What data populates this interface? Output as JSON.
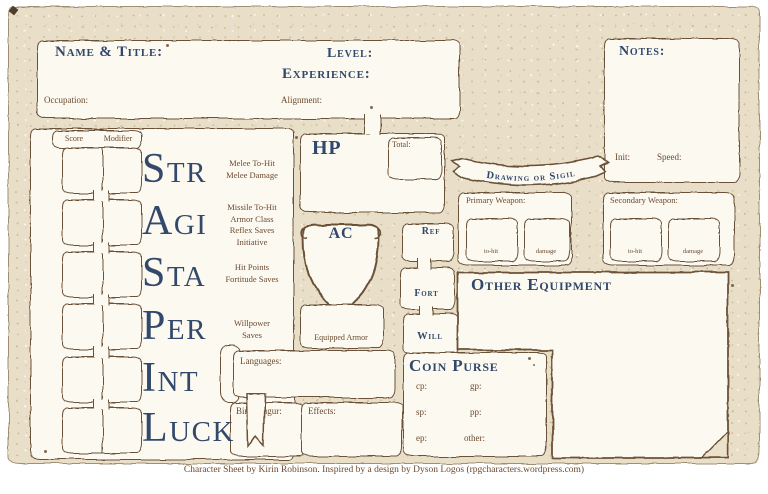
{
  "colors": {
    "ink": "#6b5137",
    "heading_blue": "#31486b",
    "label_brown": "#6b4a2f",
    "parchment": "#e9dfc9",
    "paper": "#fcf9f1"
  },
  "header": {
    "name_title": "Name & Title:",
    "occupation": "Occupation:",
    "level": "Level:",
    "experience": "Experience:",
    "alignment": "Alignment:"
  },
  "notes": {
    "title": "Notes:",
    "init": "Init:",
    "speed": "Speed:"
  },
  "stats": {
    "score_header": "Score",
    "modifier_header": "Modifier",
    "rows": [
      {
        "name": "Str",
        "labels": [
          "Melee To-Hit",
          "Melee Damage"
        ]
      },
      {
        "name": "Agi",
        "labels": [
          "Missile To-Hit",
          "Armor Class",
          "Reflex Saves",
          "Initiative"
        ]
      },
      {
        "name": "Sta",
        "labels": [
          "Hit Points",
          "Fortitude Saves"
        ]
      },
      {
        "name": "Per",
        "labels": [
          "Willpower",
          "Saves"
        ]
      },
      {
        "name": "Int",
        "labels": []
      },
      {
        "name": "Luck",
        "labels": []
      }
    ]
  },
  "hp": {
    "title": "HP",
    "total_label": "Total:"
  },
  "ac": {
    "title": "AC",
    "equipped_armor": "Equipped Armor"
  },
  "saves": {
    "ref": "Ref",
    "fort": "Fort",
    "will": "Will"
  },
  "sigil_banner": {
    "label": "Drawing or Sigil"
  },
  "weapons": {
    "primary": "Primary Weapon:",
    "secondary": "Secondary Weapon:",
    "to_hit": "to-hit",
    "damage": "damage"
  },
  "other_equipment": {
    "title": "Other Equipment"
  },
  "coin_purse": {
    "title": "Coin Purse",
    "cp": "cp:",
    "sp": "sp:",
    "ep": "ep:",
    "gp": "gp:",
    "pp": "pp:",
    "other": "other:"
  },
  "languages_label": "Languages:",
  "birth_augur_label": "Birth Augur:",
  "effects_label": "Effects:",
  "footer_credit": "Character Sheet by Kirin Robinson. Inspired by a design by Dyson Logos (rpgcharacters.wordpress.com)"
}
